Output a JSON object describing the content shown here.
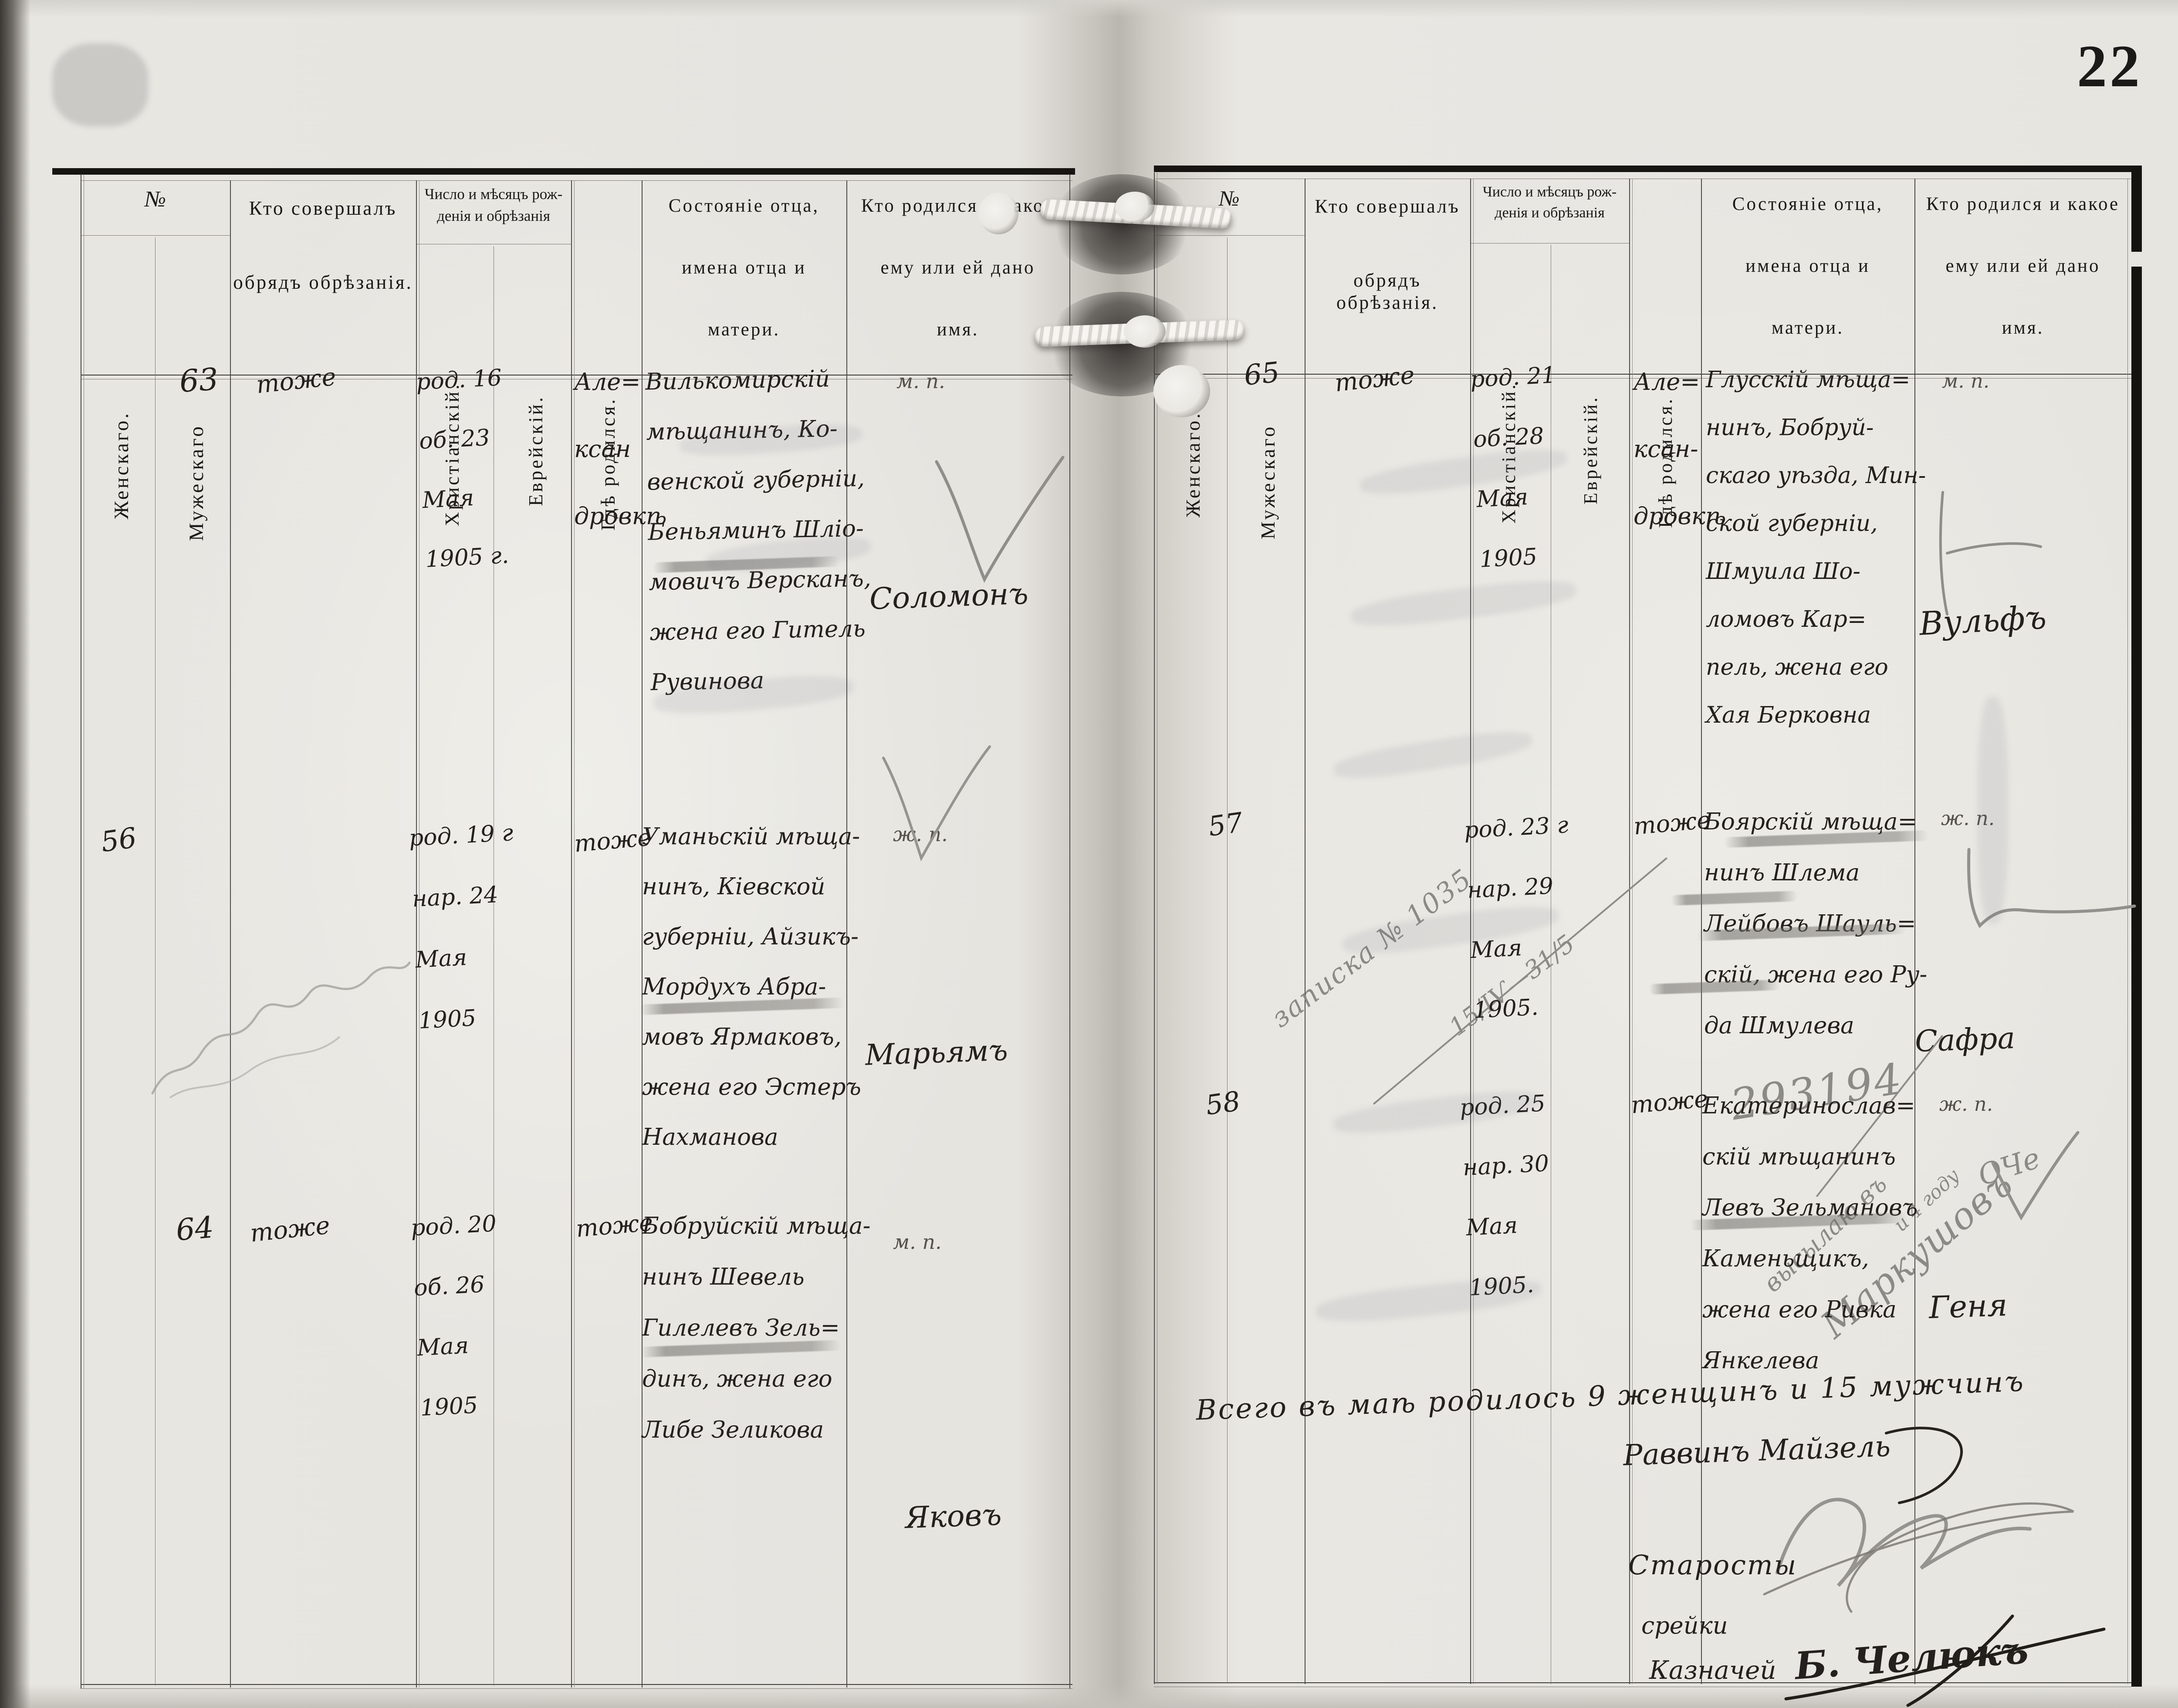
{
  "page_number": "22",
  "header": {
    "no": "№",
    "female": "Женскаго.",
    "male": "Мужескаго",
    "who_performed_1": "Кто  совершалъ",
    "who_performed_2": "обрядъ  обрѣзанія.",
    "date_group_1": "Число и мѣсяцъ рож-",
    "date_group_2": "денія и обрѣзанія",
    "christian": "Христіанскій.",
    "jewish": "Еврейскій.",
    "where_born": "Гдѣ  родился.",
    "father_1": "Состояніе отца,",
    "father_2": "имена  отца  и",
    "father_3": "матери.",
    "who_born_1": "Кто родился и какое",
    "who_born_2": "ему  или  ей  дано",
    "who_born_3": "имя."
  },
  "left_page": {
    "rows": [
      {
        "entry_no": "63",
        "mohel": "тоже",
        "date_christian": [
          "род. 16",
          "об. 23",
          "Мая",
          "1905 г."
        ],
        "where_born": [
          "Але=",
          "ксан",
          "дровкѣ"
        ],
        "parents": [
          "Вилькомирскій",
          "мѣщанинъ, Ко-",
          "венской губерніи,",
          "Беньяминъ Шліо-",
          "мовичъ Версканъ,",
          "жена его Гитель",
          "Рувинова"
        ],
        "sex_mark": "м. п.",
        "child_name": "Соломонъ"
      },
      {
        "entry_no": "56",
        "mohel": "",
        "date_christian": [
          "род. 19 г",
          "нар. 24",
          "Мая",
          "1905"
        ],
        "where_born": [
          "тоже"
        ],
        "parents": [
          "Уманьскій мѣща-",
          "нинъ, Кіевской",
          "губерніи, Айзикъ-",
          "Мордухъ Абра-",
          "мовъ Ярмаковъ,",
          "жена его Эстеръ",
          "Нахманова"
        ],
        "sex_mark": "ж. п.",
        "child_name": "Марьямъ"
      },
      {
        "entry_no": "64",
        "mohel": "тоже",
        "date_christian": [
          "род. 20",
          "об. 26",
          "Мая",
          "1905"
        ],
        "where_born": [
          "тоже"
        ],
        "parents": [
          "Бобруйскій мѣща-",
          "нинъ Шевель",
          "Гилелевъ Зель=",
          "динъ, жена его",
          "Либе Зеликова"
        ],
        "sex_mark": "м. п.",
        "child_name": "Яковъ"
      }
    ]
  },
  "right_page": {
    "rows": [
      {
        "entry_no": "65",
        "mohel": "тоже",
        "date_christian": [
          "род. 21",
          "об. 28",
          "Мая",
          "1905"
        ],
        "where_born": [
          "Але=",
          "ксан-",
          "дровкѣ"
        ],
        "parents": [
          "Глусскій мѣща=",
          "нинъ, Бобруй-",
          "скаго уѣзда, Мин-",
          "ской губерніи,",
          "Шмуила Шо-",
          "ломовъ Кар=",
          "пель, жена его",
          "Хая Берковна"
        ],
        "sex_mark": "м. п.",
        "child_name": "Вульфъ"
      },
      {
        "entry_no": "57",
        "mohel": "",
        "date_christian": [
          "род. 23 г",
          "нар. 29",
          "Мая",
          "1905."
        ],
        "where_born": [
          "тоже"
        ],
        "parents": [
          "Боярскій мѣща=",
          "нинъ Шлема",
          "Лейбовъ Шауль=",
          "скій, жена его Ру-",
          "да Шмулева"
        ],
        "sex_mark": "ж. п.",
        "child_name": "Сафра",
        "pencil_note_line1": "записка № 1035",
        "pencil_note_line2": "15/ІѴ—31/5"
      },
      {
        "entry_no": "58",
        "mohel": "",
        "date_christian": [
          "род. 25",
          "нар. 30",
          "Мая",
          "1905."
        ],
        "where_born": [
          "тоже"
        ],
        "parents": [
          "Екатеринослав=",
          "скій мѣщанинъ",
          "Левъ Зельмановъ",
          "Каменьщикъ,",
          "жена его Ривка",
          "Янкелева"
        ],
        "sex_mark": "ж. п.",
        "child_name": "Геня"
      }
    ],
    "pencil_annotations": {
      "number_crossed": "293194",
      "note_1": "высылаю въ",
      "note_2": "Маркушовъ",
      "note_3": "и 4 году",
      "note_4": "ОЧе"
    },
    "summary_line": "Всего въ маѣ родилось 9 женщинъ и 15 мужчинъ",
    "signatures": {
      "rabbi": "Раввинъ Майзель",
      "starosty_label": "Старосты",
      "second_line": "срейки",
      "treasurer_label": "Казначей",
      "treasurer_sig": "Б. Челюкъ"
    }
  }
}
